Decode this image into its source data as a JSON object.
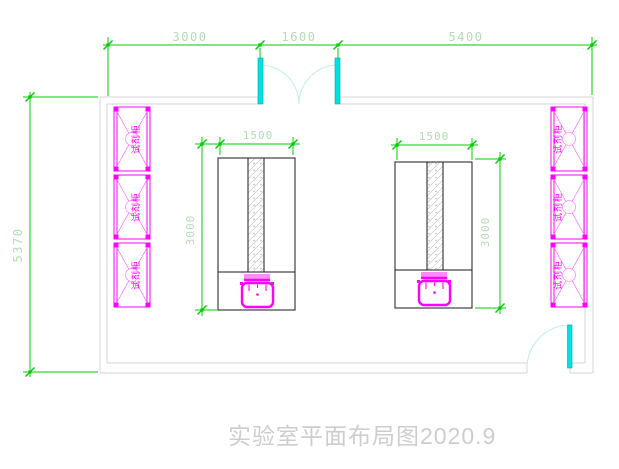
{
  "title": {
    "text": "实验室平面布局图2020.9"
  },
  "dimensions": {
    "top_left": "3000",
    "top_middle": "1600",
    "top_right": "5400",
    "room_height": "5370",
    "bench_width": "1500",
    "bench_height": "3000"
  },
  "cabinets": {
    "label": "试剂柜",
    "count_left": 3,
    "count_right": 3
  },
  "colors": {
    "dimension_green": "#00cc00",
    "dimension_text_pale_green": "#b6d9b6",
    "furniture_magenta": "#ff00ff",
    "door_cyan": "#00e2e2",
    "door_arc_cyan": "#bdeeee",
    "wall_gray": "#d4d4d4",
    "bench_black": "#1a1a1a",
    "title_gray": "#cdcdcd"
  }
}
